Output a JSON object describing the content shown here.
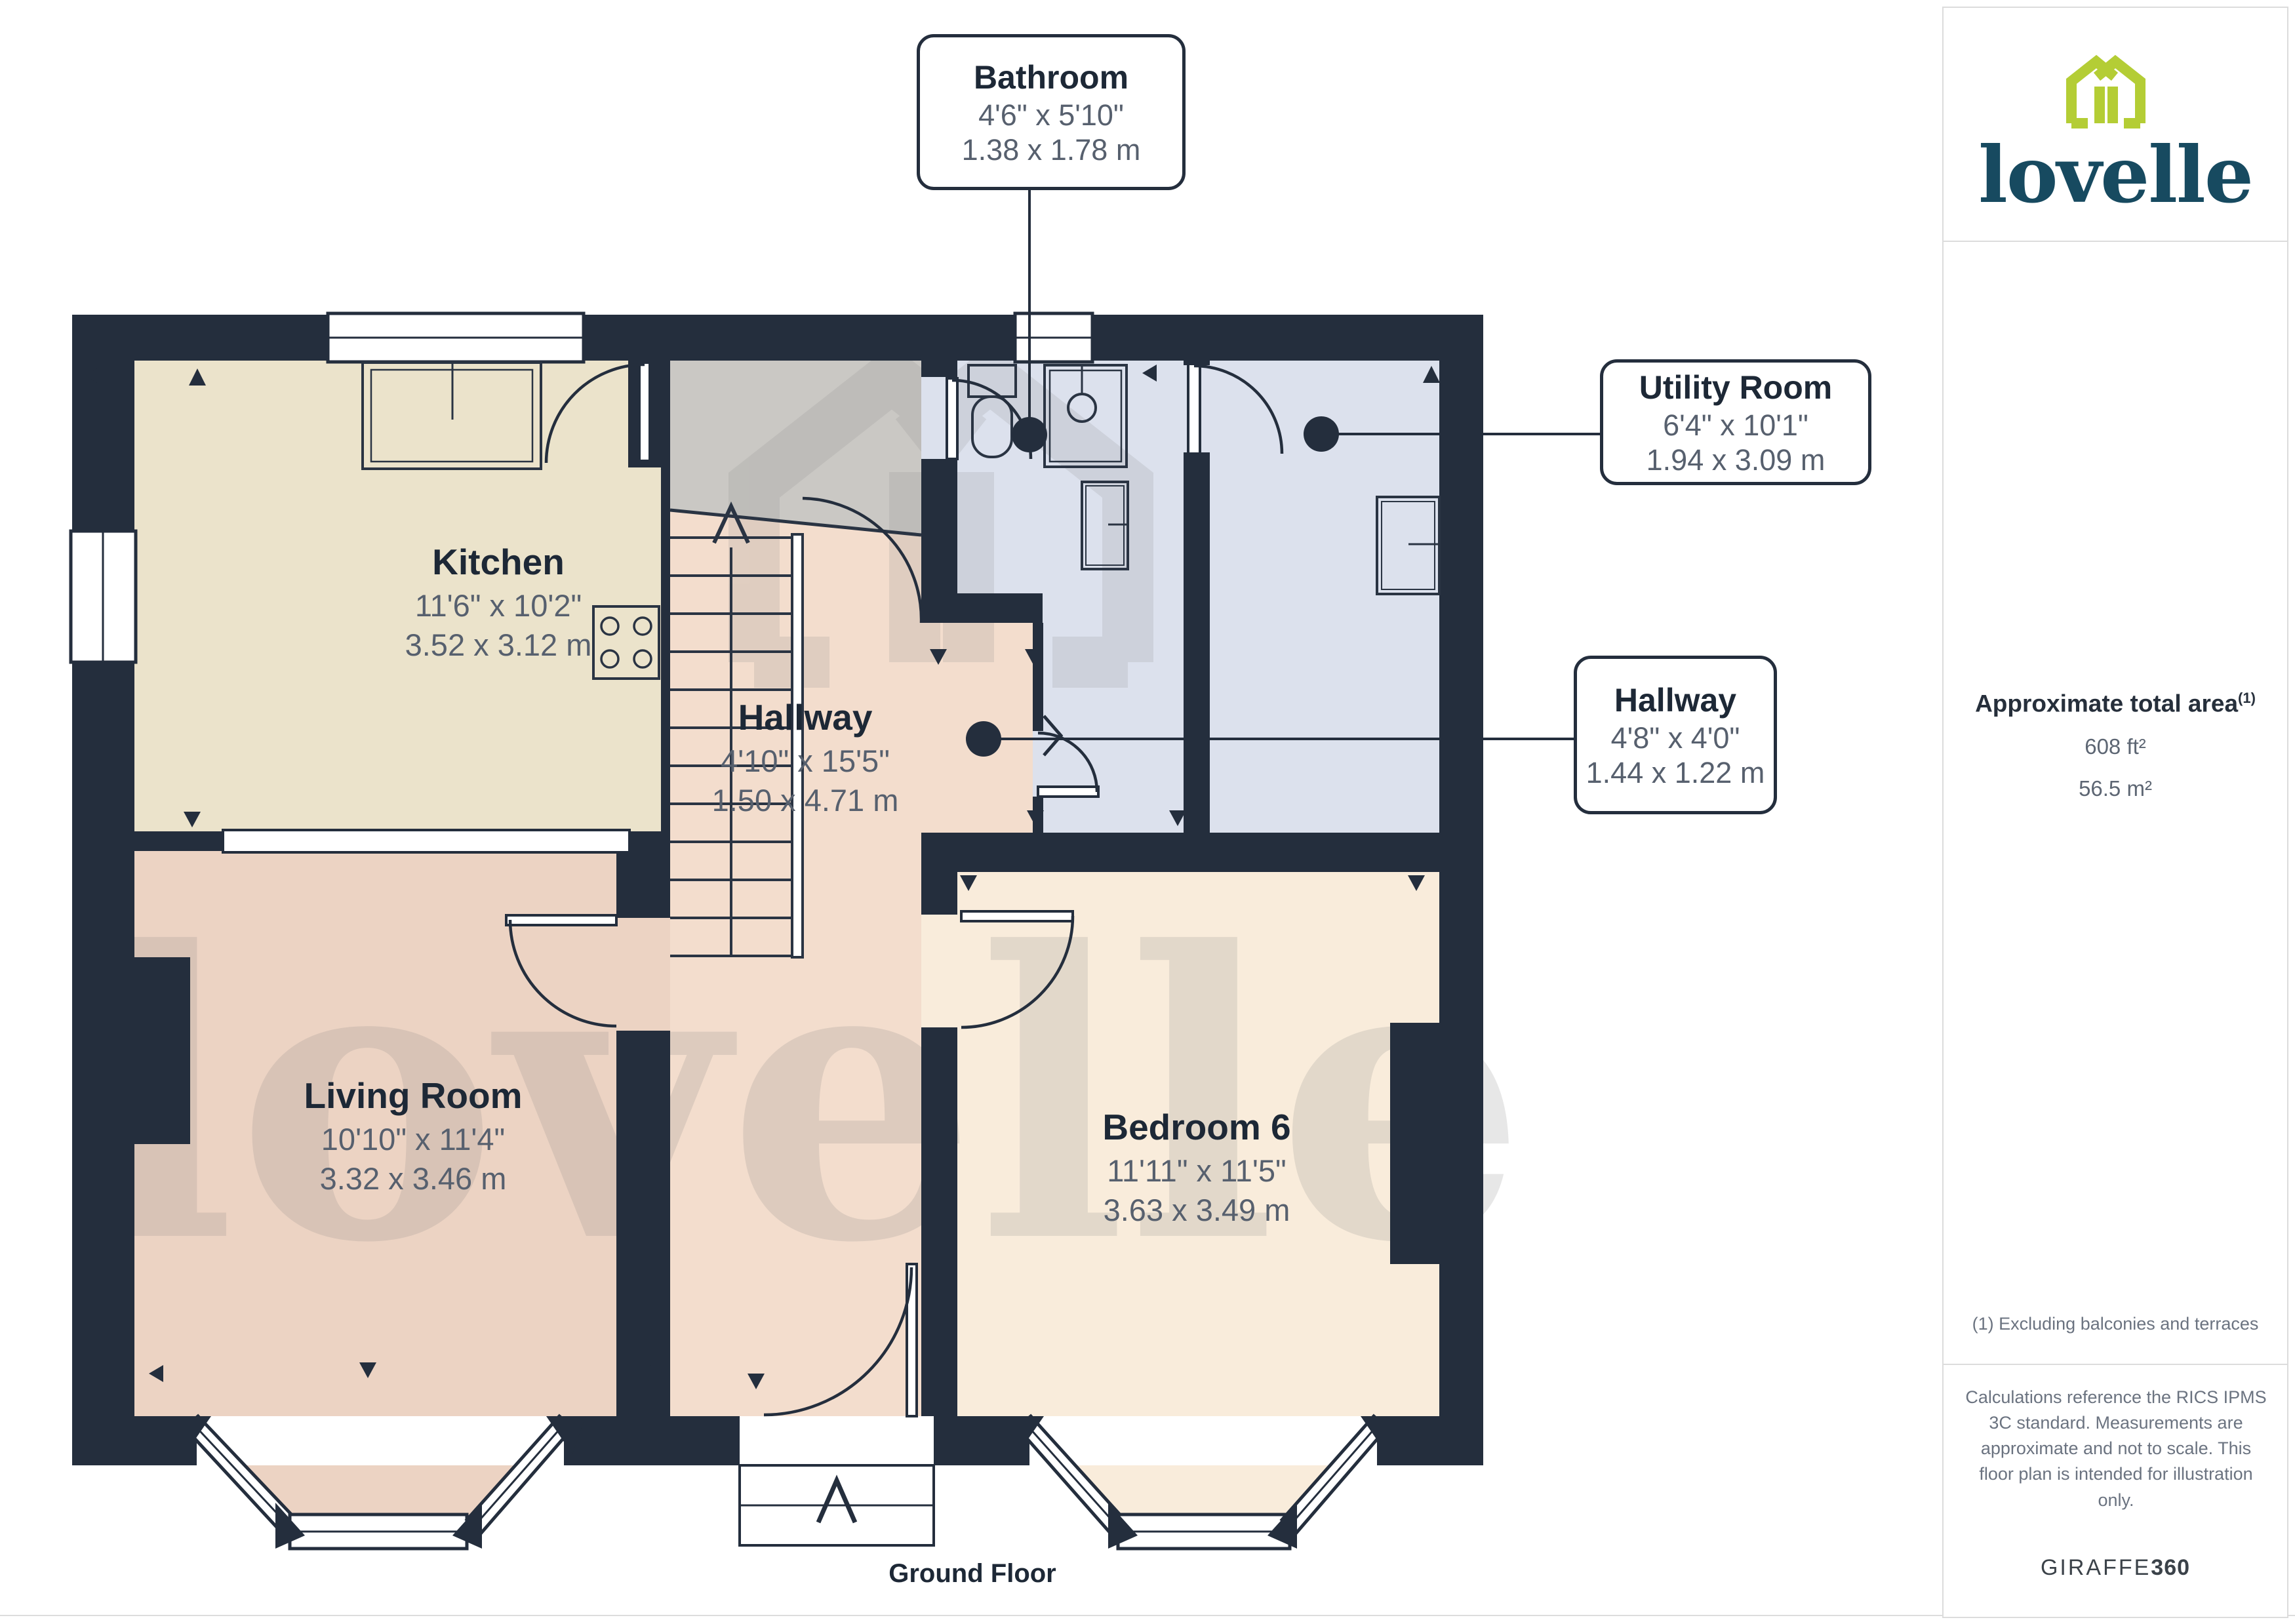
{
  "branding": {
    "logo_text": "lovelle",
    "logo_green": "#b4cd35",
    "logo_teal": "#174a60"
  },
  "sidebar": {
    "area_title": "Approximate total area",
    "area_footnote_marker": "(1)",
    "area_imperial": "608 ft²",
    "area_metric": "56.5 m²",
    "footnote": "(1) Excluding balconies and terraces",
    "disclaimer": "Calculations reference the RICS IPMS 3C standard. Measurements are approximate and not to scale. This floor plan is intended for illustration only.",
    "provider": "GIRAFFE",
    "provider_suffix": "360"
  },
  "plan": {
    "floor_label": "Ground Floor",
    "watermark": "lovelle",
    "rooms": [
      {
        "id": "kitchen",
        "name": "Kitchen",
        "imperial": "11'6\" x 10'2\"",
        "metric": "3.52 x 3.12 m"
      },
      {
        "id": "hallway-main",
        "name": "Hallway",
        "imperial": "4'10\" x 15'5\"",
        "metric": "1.50 x 4.71 m"
      },
      {
        "id": "living-room",
        "name": "Living Room",
        "imperial": "10'10\" x 11'4\"",
        "metric": "3.32 x 3.46 m"
      },
      {
        "id": "bedroom-6",
        "name": "Bedroom 6",
        "imperial": "11'11\" x 11'5\"",
        "metric": "3.63 x 3.49 m"
      }
    ],
    "callouts": [
      {
        "id": "bathroom",
        "name": "Bathroom",
        "imperial": "4'6\" x 5'10\"",
        "metric": "1.38 x 1.78 m"
      },
      {
        "id": "utility-room",
        "name": "Utility Room",
        "imperial": "6'4\" x 10'1\"",
        "metric": "1.94 x 3.09 m"
      },
      {
        "id": "hallway-small",
        "name": "Hallway",
        "imperial": "4'8\" x 4'0\"",
        "metric": "1.44 x 1.22 m"
      }
    ],
    "colors": {
      "wall": "#242e3d",
      "kitchen": "#ebe3cb",
      "hallway": "#f3ddcd",
      "living_room": "#ecd3c3",
      "bedroom": "#f9ecdb",
      "bathroom": "#dce1ed",
      "utility": "#dce1ed",
      "stairs": "#cac8c4",
      "camera_dot": "#242e3d"
    }
  }
}
